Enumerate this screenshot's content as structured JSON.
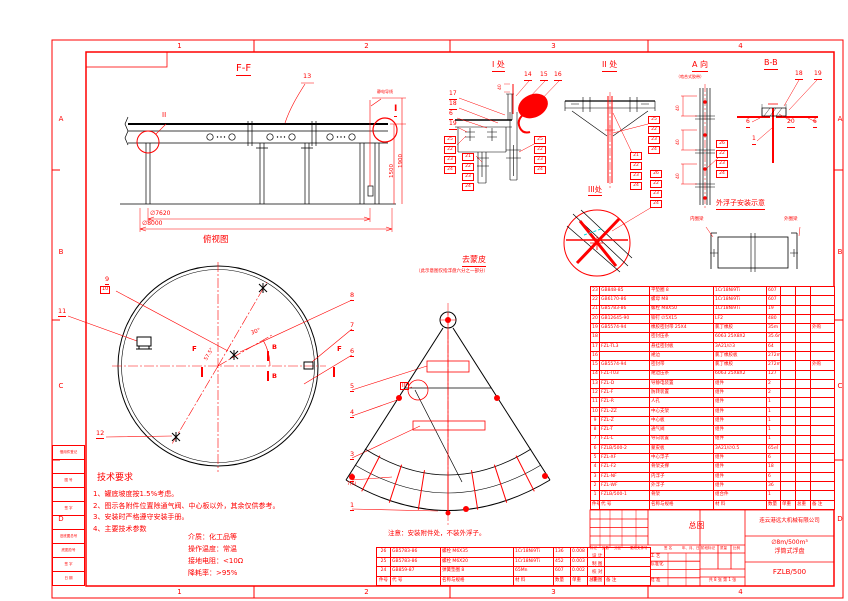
{
  "colors": {
    "line_red": "#ff0000",
    "line_black": "#000000",
    "seal_cyan": "#00dede"
  },
  "frame": {
    "zones_top": [
      "1",
      "2",
      "3",
      "4"
    ],
    "zones_bottom": [
      "1",
      "2",
      "3",
      "4"
    ],
    "zones_left": [
      "A",
      "B",
      "C",
      "D"
    ],
    "zones_right": [
      "A",
      "B",
      "C",
      "D"
    ]
  },
  "ff_view": {
    "title": "F-F",
    "balloon_13": "13",
    "static_wire_label": "静电导线",
    "detail_i_label": "I",
    "detail_ii_label": "II",
    "dim_height_inner": "1500",
    "dim_height_outer": "1900",
    "dim_dia_inner": "∅7620",
    "dim_dia_outer": "∅8000"
  },
  "top_view": {
    "title": "俯视图",
    "balloon_9": "9",
    "balloon_10": "10",
    "balloon_11": "11",
    "balloon_12": "12",
    "section_f_left": "F",
    "section_f_right": "F",
    "section_b_top": "B",
    "section_b_bottom": "B",
    "angle_30": "30°",
    "angle_57": "57.5°"
  },
  "balloon_column": {
    "b8": "8",
    "b7": "7",
    "b6": "6",
    "b5": "5",
    "b4": "4",
    "b3": "3",
    "b2": "2",
    "b2_sub": "7(6)",
    "b1": "1"
  },
  "fan_view": {
    "title": "去蒙皮",
    "subtitle": "（此示意图仅指浮盘六分之一部分）",
    "detail_iii_label": "III"
  },
  "detail_i": {
    "title": "I 处",
    "dim_40": "40",
    "b14": "14",
    "b15": "15",
    "b16": "16",
    "b17": "17",
    "b18": "18",
    "b6": "6",
    "b19": "19",
    "stack_left": [
      "25",
      "22",
      "23",
      "24"
    ],
    "stack_bottom": [
      "21",
      "22",
      "23",
      "24"
    ],
    "stack_right": [
      "25",
      "22",
      "23",
      "24"
    ]
  },
  "detail_ii": {
    "title": "II 处",
    "stack_right": [
      "25",
      "22",
      "23",
      "24"
    ],
    "stack_left": [
      "21",
      "22",
      "23",
      "24"
    ]
  },
  "detail_iii": {
    "title": "III处",
    "stack": [
      "26",
      "22",
      "23",
      "24"
    ]
  },
  "view_a": {
    "title": "A 向",
    "subtitle": "（啮合式胶带）",
    "dim1": "40",
    "dim2": "40",
    "dim3": "40",
    "stack": [
      "26",
      "22",
      "23",
      "24"
    ]
  },
  "section_bb": {
    "title": "B-B",
    "b18": "18",
    "b19": "19",
    "b6_left": "6",
    "b20": "20",
    "b6_right": "6",
    "b1": "1"
  },
  "float_install": {
    "title": "外浮子安装示意",
    "inner_beam": "内圈梁",
    "outer_beam": "外圈梁"
  },
  "tech_requirements": {
    "title": "技术要求",
    "items": [
      "1、罐底坡度按1.5%考虑。",
      "2、图示各附件位置除通气阀、中心板以外，其余仅供参考。",
      "3、安装时严格遵守安装手册。",
      "4、主要技术参数"
    ],
    "params": [
      "介质：化工品等",
      "操作温度：常温",
      "接地电阻：<10Ω",
      "降耗率：>95%"
    ]
  },
  "note": "注意：安装附件处，不装外浮子。",
  "bom_main": {
    "columns": [
      "件号",
      "代 号",
      "名称与规格",
      "材 料",
      "数量",
      "单重",
      "总重",
      "备 注"
    ],
    "rows": [
      [
        "23",
        "GB848-85",
        "平垫圈 8",
        "1Cr18Ni9Ti",
        "607",
        "",
        "",
        ""
      ],
      [
        "22",
        "GB6170-86",
        "螺母 M8",
        "1Cr18Ni9Ti",
        "607",
        "",
        "",
        ""
      ],
      [
        "21",
        "GB5783-86",
        "螺栓 M8X50",
        "1Cr18Ni9Ti",
        "19",
        "",
        "",
        ""
      ],
      [
        "20",
        "GB12645-90",
        "铆钉 ∅5X15",
        "LF2",
        "480",
        "",
        "",
        ""
      ],
      [
        "19",
        "GB5574-94",
        "橡胶密封带 25X4",
        "氯丁橡胶",
        "35m",
        "",
        "",
        "外购"
      ],
      [
        "18",
        "",
        "密封压条",
        "6063 25X8X2",
        "35.6m",
        "",
        "",
        ""
      ],
      [
        "17",
        "FZL-TL3",
        "悬挂密封板",
        "3A21/∅3",
        "64",
        "",
        "",
        ""
      ],
      [
        "16",
        "",
        "裙边",
        "氯丁橡胶板",
        "272m",
        "",
        "",
        ""
      ],
      [
        "15",
        "GB5574-94",
        "密封带",
        "氯丁橡胶",
        "272m",
        "",
        "",
        "外购"
      ],
      [
        "14",
        "FZL-T03",
        "裙边压条",
        "6063 25X8X2",
        "127",
        "",
        "",
        ""
      ],
      [
        "13",
        "FZL-D",
        "导静电装置",
        "组件",
        "2",
        "",
        "",
        ""
      ],
      [
        "12",
        "FZL-F",
        "防转装置",
        "组件",
        "2",
        "",
        "",
        ""
      ],
      [
        "11",
        "FZL-R",
        "人孔",
        "组件",
        "1",
        "",
        "",
        ""
      ],
      [
        "10",
        "FZL-ZZ",
        "中心支架",
        "组件",
        "1",
        "",
        "",
        ""
      ],
      [
        "9",
        "FZL-Z",
        "中心板",
        "组件",
        "1",
        "",
        "",
        ""
      ],
      [
        "8",
        "FZL-T",
        "通气阀",
        "组件",
        "1",
        "",
        "",
        ""
      ],
      [
        "7",
        "FZL-L",
        "导向装置",
        "组件",
        "1",
        "",
        "",
        ""
      ],
      [
        "6",
        "FZLB/500-2",
        "蒙皮板",
        "3A21/∅0.5",
        "65㎡",
        "",
        "",
        ""
      ],
      [
        "5",
        "FZL-XF",
        "中心浮子",
        "组件",
        "6",
        "",
        "",
        ""
      ],
      [
        "4",
        "FZL-F2",
        "骨架支撑",
        "组件",
        "18",
        "",
        "",
        ""
      ],
      [
        "3",
        "FZL-NF",
        "内浮子",
        "组件",
        "6",
        "",
        "",
        ""
      ],
      [
        "2",
        "FZL-WF",
        "外浮子",
        "组件",
        "36",
        "",
        "",
        ""
      ],
      [
        "1",
        "FZLB/500-1",
        "骨架",
        "组合件",
        "1",
        "",
        "",
        ""
      ]
    ]
  },
  "bom_small": {
    "columns": [
      "件号",
      "代 号",
      "名称与规格",
      "材 料",
      "数量",
      "单重",
      "总重",
      "备 注"
    ],
    "rows": [
      [
        "26",
        "GB5783-86",
        "螺栓 M6X35",
        "1Cr18Ni9Ti",
        "136",
        "0.008",
        "",
        ""
      ],
      [
        "25",
        "GB5783-86",
        "螺栓 M6X20",
        "1Cr18Ni9Ti",
        "452",
        "0.003",
        "",
        ""
      ],
      [
        "24",
        "GB859-87",
        "弹簧垫圈 8",
        "65Mn",
        "607",
        "0.002",
        "",
        ""
      ]
    ]
  },
  "title_block": {
    "drawing_type": "总图",
    "company": "连云港远大机械有限公司",
    "product_line1": "∅8m/500m³",
    "product_line2": "浮筒式浮盘",
    "drawing_no": "FZLB/500",
    "sheet_info": "共 8 张 第 1 张",
    "rev_headers": [
      "标记",
      "处数",
      "分区",
      "更改文件号",
      "签 名",
      "年、月、日"
    ],
    "sign_rows_left": [
      "设 计",
      "制 图",
      "校 对",
      "审 图"
    ],
    "sign_rows_right": [
      "工 艺",
      "标准化",
      "",
      "批 准"
    ],
    "stage_headers": [
      "阶段标记",
      "质量",
      "比例"
    ]
  },
  "margin_strip": {
    "labels": [
      "借用件登记",
      "",
      "图 号",
      "",
      "签 字",
      "",
      "旧底图总号",
      "底图总号",
      "签 字",
      "日 期"
    ]
  }
}
